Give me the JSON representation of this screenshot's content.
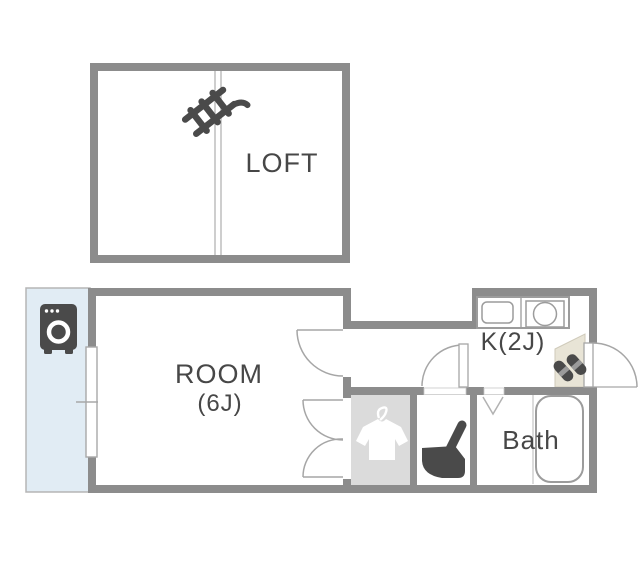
{
  "rooms": {
    "loft": {
      "label": "LOFT"
    },
    "main": {
      "label": "ROOM",
      "size": "(6J)"
    },
    "kitchen": {
      "label": "K(2J)"
    },
    "bath": {
      "label": "Bath"
    }
  },
  "icons": [
    "ladder-icon",
    "washing-machine-icon",
    "window-symbol",
    "door-swing-symbol",
    "closet-double-door-symbol",
    "folding-door-symbol",
    "hanger-shirt-icon",
    "toilet-icon",
    "slippers-icon",
    "sink-icon",
    "stove-icon",
    "bathtub-icon"
  ],
  "colors": {
    "wall": "#8c8c8c",
    "balcony_fill": "#e1ecf4",
    "balcony_border": "#b5b5b5",
    "closet_fill": "#dbdbdb",
    "entry_fill": "#e8e4d6",
    "icon_dark": "#4a4a4a",
    "text": "#474747"
  }
}
